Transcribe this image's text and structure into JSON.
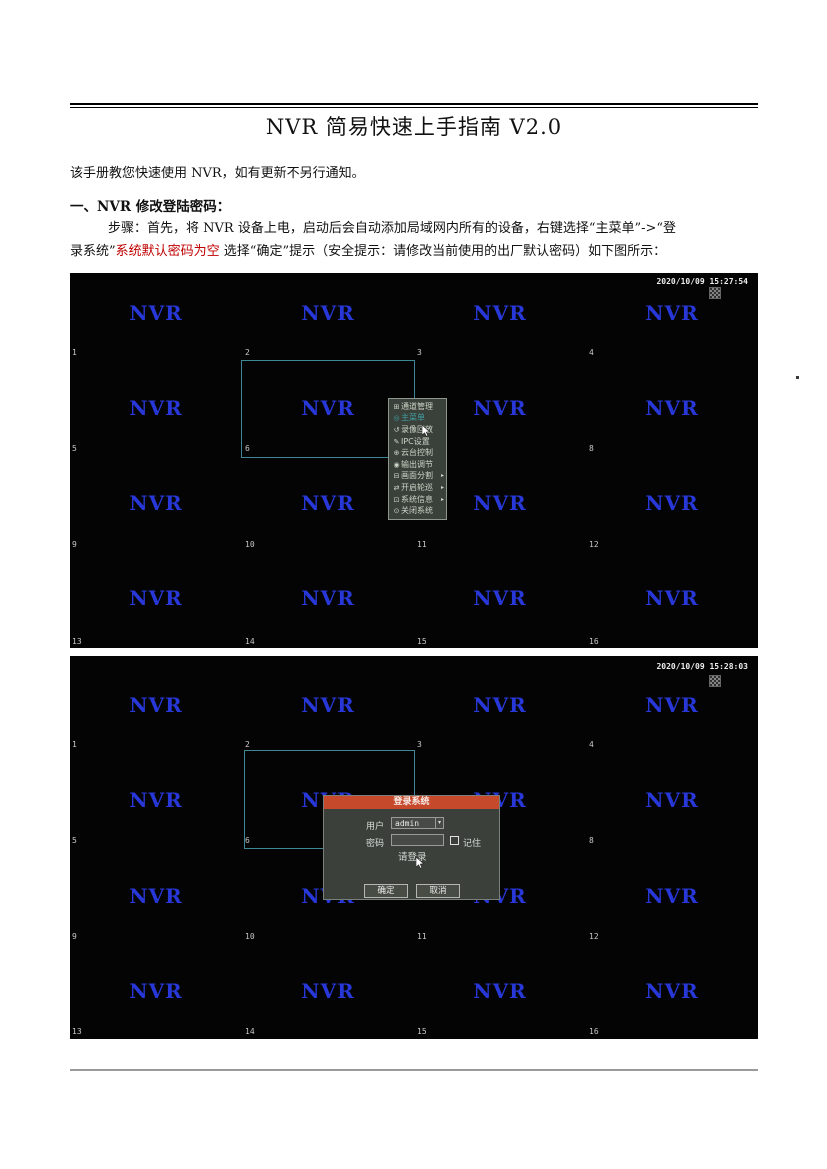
{
  "doc": {
    "title": "NVR 简易快速上手指南 V2.0",
    "intro": "该手册教您快速使用 NVR，如有更新不另行通知。",
    "section_heading": "一、NVR 修改登陆密码：",
    "step_line1": "步骤：首先，将 NVR 设备上电，启动后会自动添加局域网内所有的设备，右键选择“主菜单”->“登",
    "step_line2_pre": "录系统”",
    "step_line2_red": "系统默认密码为空",
    "step_line2_post": " 选择“确定”提示（安全提示：请修改当前使用的出厂默认密码）如下图所示：",
    "red_color": "#c00000"
  },
  "grid": {
    "nvr_label": "NVR",
    "nvr_color": "#2838d8",
    "selection_color": "#3e8896",
    "selected_channel": "6",
    "numbers": [
      "1",
      "2",
      "3",
      "4",
      "5",
      "6",
      "7",
      "8",
      "9",
      "10",
      "11",
      "12",
      "13",
      "14",
      "15",
      "16"
    ]
  },
  "screenshot1": {
    "timestamp": "2020/10/09 15:27:54",
    "menu": {
      "highlight_color": "#3fa0a2",
      "items": [
        {
          "label": "通道管理",
          "icon": "channel-manage-icon",
          "glyph": "⊞"
        },
        {
          "label": "主菜单",
          "icon": "main-menu-icon",
          "glyph": "◎"
        },
        {
          "label": "录像回放",
          "icon": "playback-icon",
          "glyph": "↺"
        },
        {
          "label": "IPC设置",
          "icon": "ipc-settings-icon",
          "glyph": "✎"
        },
        {
          "label": "云台控制",
          "icon": "ptz-control-icon",
          "glyph": "⊕"
        },
        {
          "label": "输出调节",
          "icon": "output-adjust-icon",
          "glyph": "◉"
        },
        {
          "label": "画面分割",
          "icon": "screen-split-icon",
          "glyph": "⊟",
          "submenu_marker": "▸"
        },
        {
          "label": "开启轮巡",
          "icon": "start-tour-icon",
          "glyph": "⇄",
          "submenu_marker": "▸"
        },
        {
          "label": "系统信息",
          "icon": "system-info-icon",
          "glyph": "⊡",
          "submenu_marker": "▸"
        },
        {
          "label": "关闭系统",
          "icon": "power-icon",
          "glyph": "⊙"
        }
      ]
    }
  },
  "screenshot2": {
    "timestamp": "2020/10/09 15:28:03",
    "login_dialog": {
      "title": "登录系统",
      "titlebar_color": "#c7492c",
      "user_label": "用户",
      "user_value": "admin",
      "caret_glyph": "▾",
      "password_label": "密码",
      "password_value": "",
      "remember_label": "记住",
      "hint": "请登录",
      "ok_label": "确定",
      "cancel_label": "取消"
    }
  }
}
